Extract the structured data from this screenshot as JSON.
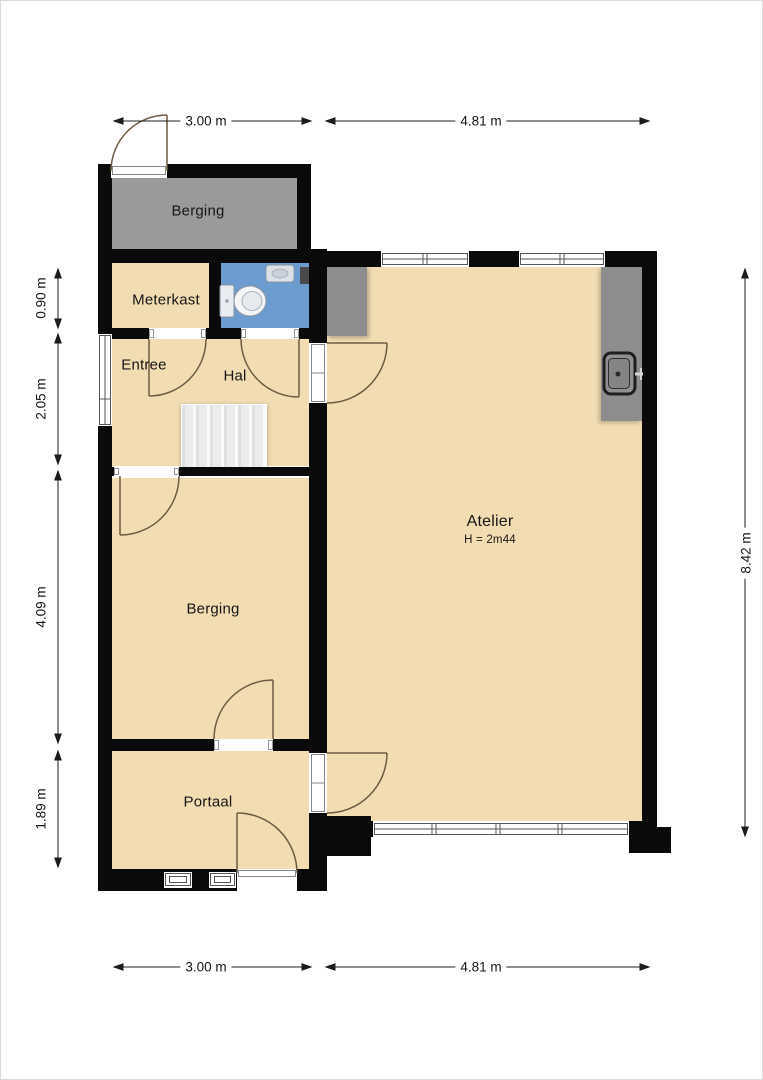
{
  "plan": {
    "rooms": {
      "berging_top": {
        "label": "Berging"
      },
      "meterkast": {
        "label": "Meterkast"
      },
      "entree": {
        "label": "Entree"
      },
      "hal": {
        "label": "Hal"
      },
      "atelier": {
        "label": "Atelier",
        "height_note": "H = 2m44"
      },
      "berging": {
        "label": "Berging"
      },
      "portaal": {
        "label": "Portaal"
      }
    },
    "dimensions": {
      "top_left": "3.00 m",
      "top_right": "4.81 m",
      "bottom_left": "3.00 m",
      "bottom_right": "4.81 m",
      "left_1": "0.90 m",
      "left_2": "2.05 m",
      "left_3": "4.09 m",
      "left_4": "1.89 m",
      "right_1": "8.42 m"
    },
    "colors": {
      "floor": "#f2dcb2",
      "cold_storage": "#9a9a9a",
      "bathroom": "#6c9bd0",
      "wall": "#0a0a0a",
      "fixture": "#8d8d8d"
    }
  }
}
